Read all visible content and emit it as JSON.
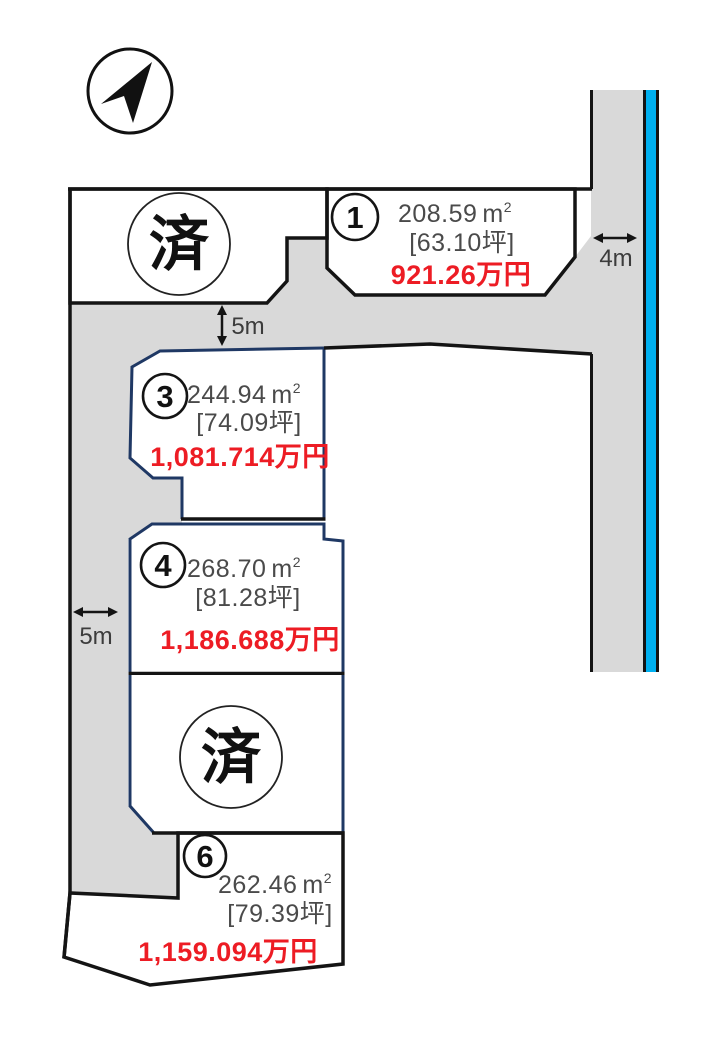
{
  "map_title": "land-plot-sales-map",
  "compass": {
    "icon": "north-arrow"
  },
  "dimensions": {
    "right_road": "4m",
    "top_road": "5m",
    "left_road": "5m"
  },
  "units": {
    "sqm_base": "m",
    "sqm_sup": "2"
  },
  "plots": [
    {
      "number": "1",
      "area_sqm": "208.59",
      "tsubo": "[63.10坪]",
      "price": "921.26万円",
      "status": "available"
    },
    {
      "label": "済",
      "status": "sold"
    },
    {
      "number": "3",
      "area_sqm": "244.94",
      "tsubo": "[74.09坪]",
      "price": "1,081.714万円",
      "status": "available"
    },
    {
      "number": "4",
      "area_sqm": "268.70",
      "tsubo": "[81.28坪]",
      "price": "1,186.688万円",
      "status": "available"
    },
    {
      "label": "済",
      "status": "sold"
    },
    {
      "number": "6",
      "area_sqm": "262.46",
      "tsubo": "[79.39坪]",
      "price": "1,159.094万円",
      "status": "available"
    }
  ],
  "colors": {
    "road": "#d9d9d9",
    "waterway": "#00b0f0",
    "price_red": "#ed1c24",
    "navy_border": "#1f3864",
    "black_border": "#141414"
  }
}
